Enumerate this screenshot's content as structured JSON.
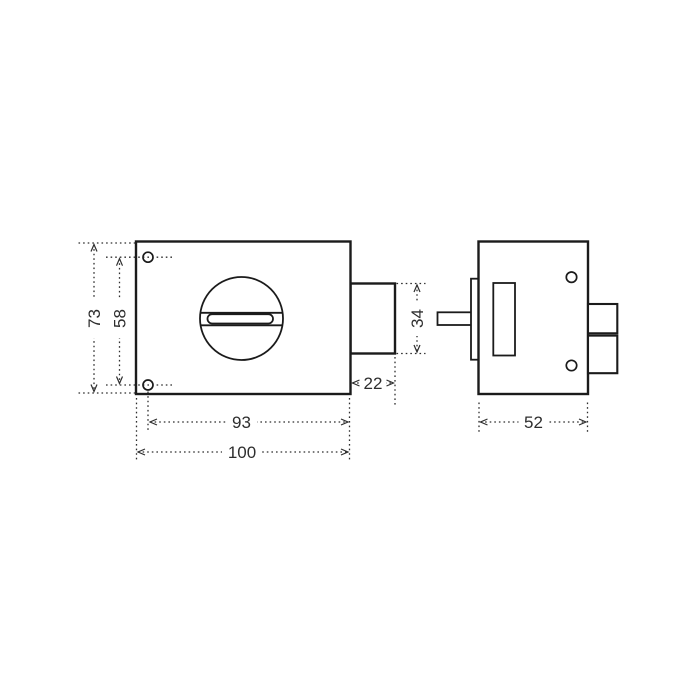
{
  "colors": {
    "line": "#1b1b1b",
    "dim": "#2e2e2e",
    "background": "#ffffff"
  },
  "drawing": {
    "dimensions": {
      "overall_height": "73",
      "hole_spacing": "58",
      "hole_to_edge": "93",
      "overall_width": "100",
      "bolt_depth": "22",
      "bolt_height": "34",
      "case_depth": "52"
    }
  }
}
